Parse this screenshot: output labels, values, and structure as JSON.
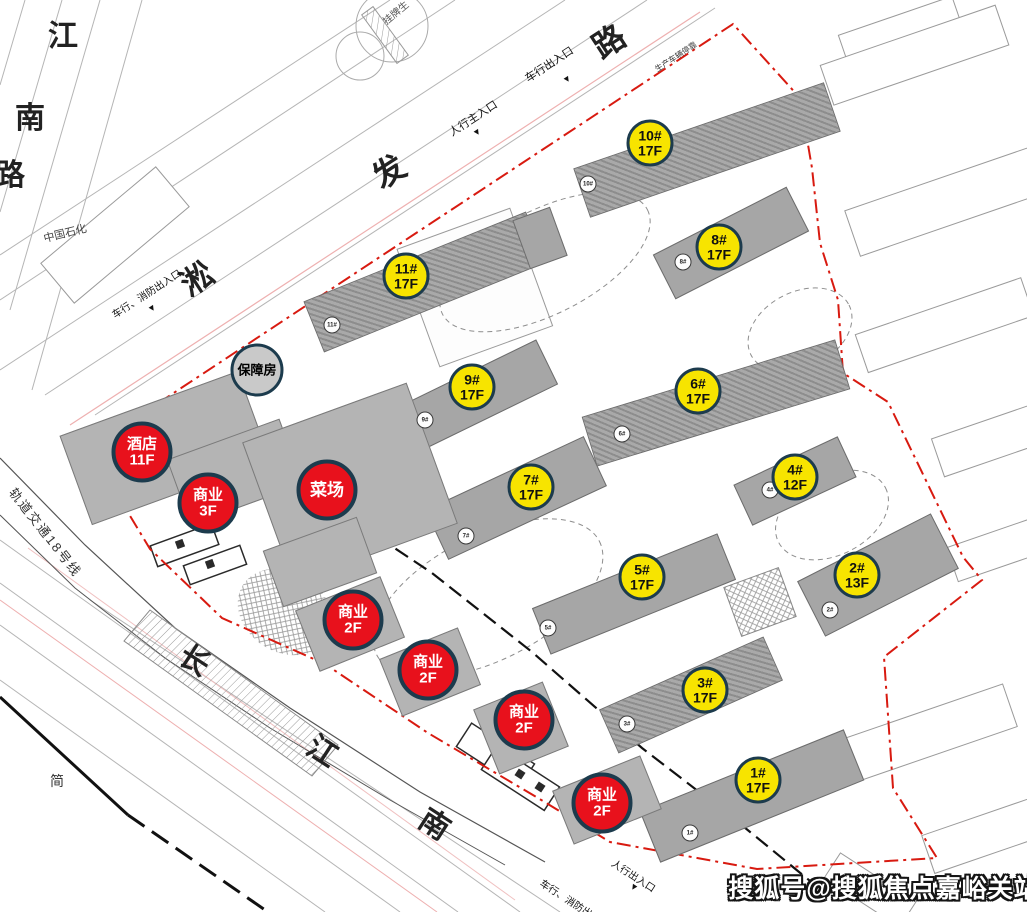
{
  "watermark": "搜狐号@搜狐焦点嘉峪关站",
  "roads": {
    "jiangnan_chars": [
      "江",
      "南",
      "路"
    ],
    "songfa_chars": [
      "淞",
      "发",
      "路"
    ],
    "changjiang_chars": [
      "长",
      "江",
      "南"
    ],
    "metro_label": "轨道交通18号线",
    "sinopec_label": "中国石化",
    "jian_label": "简",
    "guapai_label": "挂牌生"
  },
  "entrances": {
    "vehicle_top": "车行出入口",
    "pedestrian_main": "人行主入口",
    "vehicle_fire_left": "车行、消防出入口",
    "truck_stop": "生产车辆停靠",
    "pedestrian_bottom": "人行出入口",
    "vehicle_fire_bottom": "车行、消防出入口"
  },
  "buildings": {
    "residential": [
      {
        "num": "10#",
        "floors": "17F"
      },
      {
        "num": "8#",
        "floors": "17F"
      },
      {
        "num": "11#",
        "floors": "17F"
      },
      {
        "num": "9#",
        "floors": "17F"
      },
      {
        "num": "6#",
        "floors": "17F"
      },
      {
        "num": "7#",
        "floors": "17F"
      },
      {
        "num": "4#",
        "floors": "12F"
      },
      {
        "num": "5#",
        "floors": "17F"
      },
      {
        "num": "2#",
        "floors": "13F"
      },
      {
        "num": "3#",
        "floors": "17F"
      },
      {
        "num": "1#",
        "floors": "17F"
      }
    ],
    "commercial": [
      {
        "line1": "酒店",
        "line2": "11F"
      },
      {
        "line1": "商业",
        "line2": "3F"
      },
      {
        "line1": "菜场",
        "line2": ""
      },
      {
        "line1": "商业",
        "line2": "2F"
      },
      {
        "line1": "商业",
        "line2": "2F"
      },
      {
        "line1": "商业",
        "line2": "2F"
      },
      {
        "line1": "商业",
        "line2": "2F"
      }
    ],
    "support_housing": "保障房"
  },
  "colors": {
    "residential_badge": "#f7e400",
    "commercial_badge": "#e8111c",
    "support_badge": "#c9c9c9",
    "badge_border": "#1c3b4d",
    "boundary_red": "#d81a10"
  }
}
